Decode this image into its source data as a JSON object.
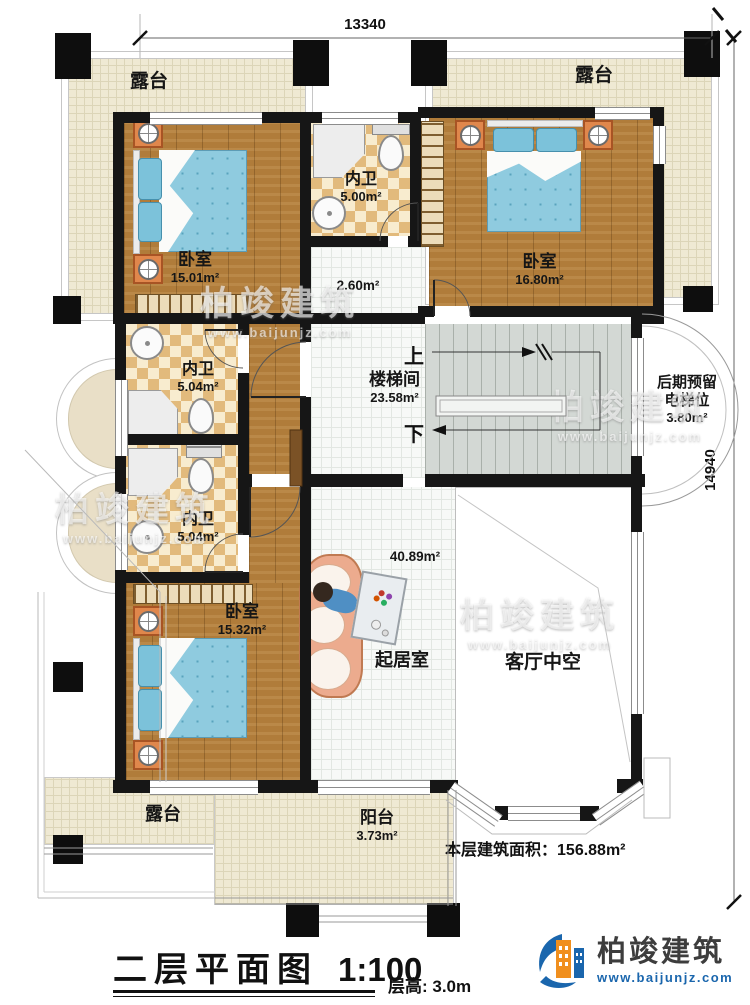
{
  "dimensions": {
    "top": "13340",
    "right": "14940"
  },
  "rooms": {
    "terrace_top_left": {
      "name": "露台"
    },
    "terrace_top_right": {
      "name": "露台"
    },
    "terrace_bottom_left": {
      "name": "露台"
    },
    "bedroom_top_left": {
      "name": "卧室",
      "area": "15.01m²"
    },
    "bath_top": {
      "name": "内卫",
      "area": "5.00m²"
    },
    "corridor": {
      "area": "2.60m²"
    },
    "bedroom_top_right": {
      "name": "卧室",
      "area": "16.80m²"
    },
    "stairwell": {
      "name": "楼梯间",
      "area": "23.58m²",
      "up": "上",
      "down": "下"
    },
    "elevator_reserve": {
      "line1": "后期预留",
      "line2": "电梯位",
      "area": "3.80m²"
    },
    "bath_middle": {
      "name": "内卫",
      "area": "5.04m²"
    },
    "bath_lower": {
      "name": "内卫",
      "area": "5.04m²"
    },
    "bedroom_bottom_left": {
      "name": "卧室",
      "area": "15.32m²"
    },
    "living_room": {
      "name": "起居室",
      "area": "40.89m²"
    },
    "void": {
      "name": "客厅中空"
    },
    "balcony": {
      "name": "阳台",
      "area": "3.73m²"
    }
  },
  "summary": {
    "floor_area_label": "本层建筑面积：",
    "floor_area_value": "156.88m²"
  },
  "titleblock": {
    "title": "二层平面图",
    "scale": "1:100",
    "floor_height": "层高: 3.0m"
  },
  "logo": {
    "name": "柏竣建筑",
    "url": "www.baijunjz.com"
  },
  "watermark": {
    "text": "柏竣建筑",
    "url": "www.baijunjz.com"
  },
  "colors": {
    "wall": "#161616",
    "wood": "#b07c3a",
    "tile_checker": "#e2ba7c",
    "terrace": "#efe9d3",
    "bed": "#8fcbdf",
    "stair": "#d3d8d4",
    "logo_blue": "#1a66ad",
    "logo_orange": "#f08f1e"
  }
}
